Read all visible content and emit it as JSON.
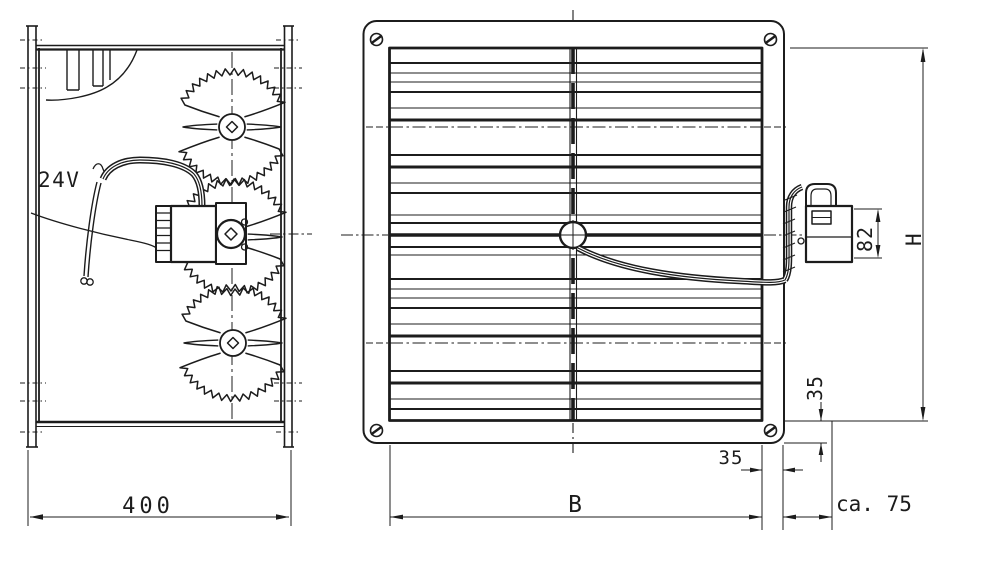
{
  "drawing": {
    "side_view": {
      "voltage_label": "24V",
      "width_dim": "400"
    },
    "front_view": {
      "width_dim": "B",
      "height_dim": "H",
      "frame_profile_dim": "35",
      "flange_depth_dim": "35",
      "actuator_height_dim": "82",
      "actuator_protrusion_dim": "ca. 75"
    },
    "colors": {
      "ink": "#1c1c1c",
      "paper": "#ffffff"
    }
  }
}
